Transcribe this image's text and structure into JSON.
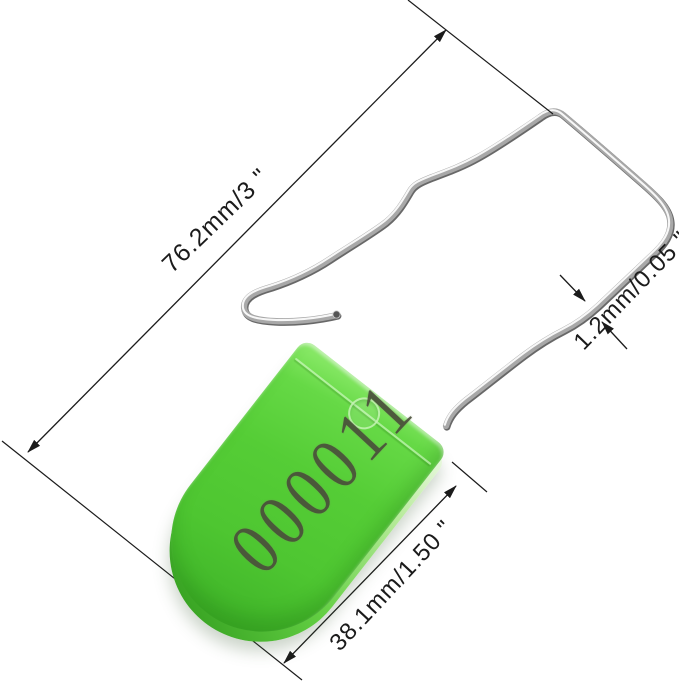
{
  "product_photo": {
    "background_color": "#ffffff",
    "description": "Green plastic padlock security seal with numbered tag and steel wire shackle, annotated with dimensions"
  },
  "seal": {
    "serial_number": "000011",
    "tag_color": "#52c834",
    "tag_highlight_color": "#8fec6d",
    "tag_shadow_color": "#2f9a1c",
    "number_color": "#4a4f3b",
    "wire_color": "#a8a8a8",
    "wire_dark_color": "#4d4d4d",
    "wire_highlight_color": "#fbfbfb"
  },
  "annotations": {
    "line_color": "#1b1b1b",
    "overall_length_label": "76.2mm/3 \"",
    "wire_thickness_label": "1.2mm/0.05 \"",
    "tag_width_label": "38.1mm/1.50 \""
  }
}
